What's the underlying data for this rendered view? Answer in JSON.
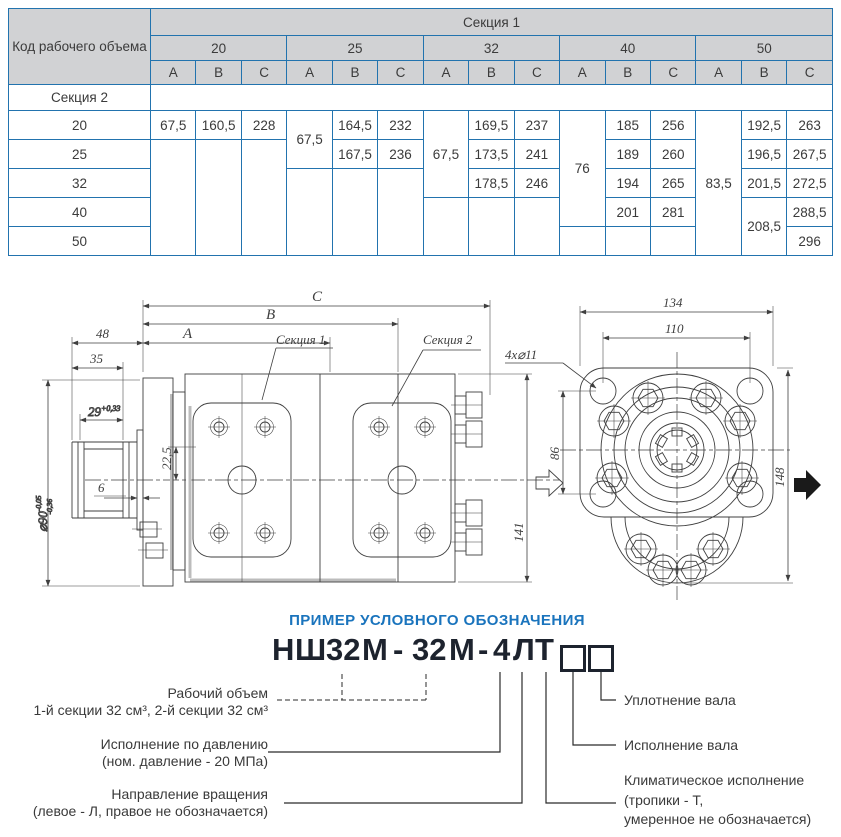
{
  "table": {
    "corner": "Код рабочего объема",
    "section1": "Секция 1",
    "section2": "Секция 2",
    "codes": [
      "20",
      "25",
      "32",
      "40",
      "50"
    ],
    "abc": [
      "A",
      "B",
      "C"
    ],
    "rows": [
      "20",
      "25",
      "32",
      "40",
      "50"
    ],
    "v": {
      "g20A20": "67,5",
      "g20B20": "160,5",
      "g20C20": "228",
      "g25A": "67,5",
      "g25B20": "164,5",
      "g25C20": "232",
      "g25B25": "167,5",
      "g25C25": "236",
      "g32A": "67,5",
      "g32B20": "169,5",
      "g32C20": "237",
      "g32B25": "173,5",
      "g32C25": "241",
      "g32B32": "178,5",
      "g32C32": "246",
      "g40A": "76",
      "g40B20": "185",
      "g40C20": "256",
      "g40B25": "189",
      "g40C25": "260",
      "g40B32": "194",
      "g40C32": "265",
      "g40B40": "201",
      "g40C40": "281",
      "g50A": "83,5",
      "g50B20": "192,5",
      "g50C20": "263",
      "g50B25": "196,5",
      "g50C25": "267,5",
      "g50B32": "201,5",
      "g50C32": "272,5",
      "g50B4050": "208,5",
      "g50C40": "288,5",
      "g50C50": "296"
    }
  },
  "drawing": {
    "dims": {
      "c": "C",
      "b": "B",
      "a": "A",
      "d48": "48",
      "d35": "35",
      "d29": "29",
      "d29tol": "+0,33",
      "d90": "⌀90",
      "d90sup": "-0,05",
      "d90sub": "-0,36",
      "d6": "6",
      "d225": "22,5",
      "d141": "141",
      "sec1": "Секция 1",
      "sec2": "Секция 2",
      "holes": "4х⌀11",
      "d134": "134",
      "d110": "110",
      "d86": "86",
      "d148": "148"
    }
  },
  "designation": {
    "heading": "ПРИМЕР УСЛОВНОГО ОБОЗНАЧЕНИЯ",
    "parts": {
      "p1": "Н",
      "p2": "Ш",
      "p3": "32",
      "p4": "М",
      "p5": "-",
      "p6": "32",
      "p7": "М",
      "p8": "-",
      "p9": "4",
      "p10": "Л",
      "p11": "Т"
    },
    "left": [
      {
        "l1": "Рабочий объем",
        "l2": "1-й секции 32 см³, 2-й секции 32 см³"
      },
      {
        "l1": "Исполнение по давлению",
        "l2": "(ном. давление - 20 МПа)"
      },
      {
        "l1": "Направление вращения",
        "l2": "(левое - Л, правое не обозначается)"
      }
    ],
    "right": [
      {
        "l1": "Уплотнение вала"
      },
      {
        "l1": "Исполнение вала"
      },
      {
        "l1": "Климатическое исполнение",
        "l2": "(тропики - Т,",
        "l3": "умеренное не обозначается)"
      }
    ]
  }
}
